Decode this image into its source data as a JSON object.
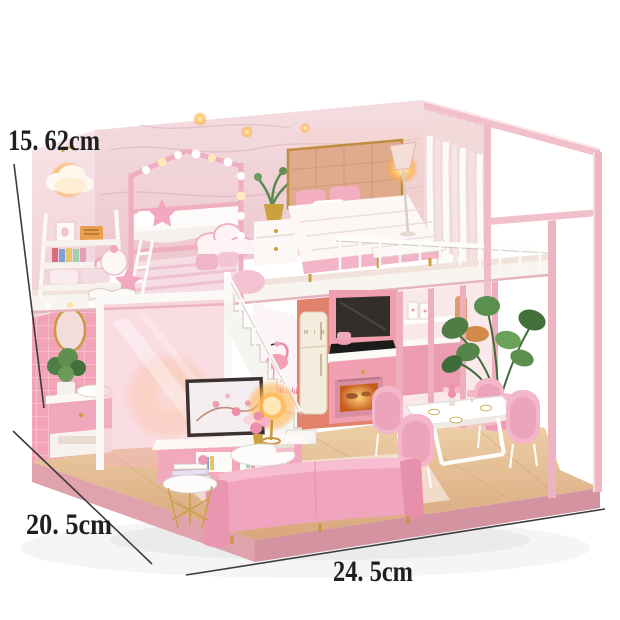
{
  "dimensions": {
    "height": "15. 62cm",
    "depth": "20. 5cm",
    "width": "24. 5cm"
  },
  "decals": {
    "stair_wall": "Pink World",
    "fridge_brand": "M I B"
  },
  "colors": {
    "background": "#ffffff",
    "annotation_text": "#1f1f1f",
    "annotation_line": "#3b3b3b",
    "wall_pink": "#f0d3d9",
    "tile_pink": "#f2a3b6",
    "frame_pink": "#f2bfcb",
    "sofa_pink": "#f1a4bd",
    "cabinet_pink": "#f0a0b2",
    "kitchen_wall_salmon": "#e2826b",
    "fridge_cream": "#f4ecdc",
    "wood_floor": "#e3bb8f",
    "base_pink": "#dca0ab",
    "glow_orange": "#ffab45",
    "plant_green": "#4e7d45",
    "stair_white": "#f7f5f2"
  }
}
